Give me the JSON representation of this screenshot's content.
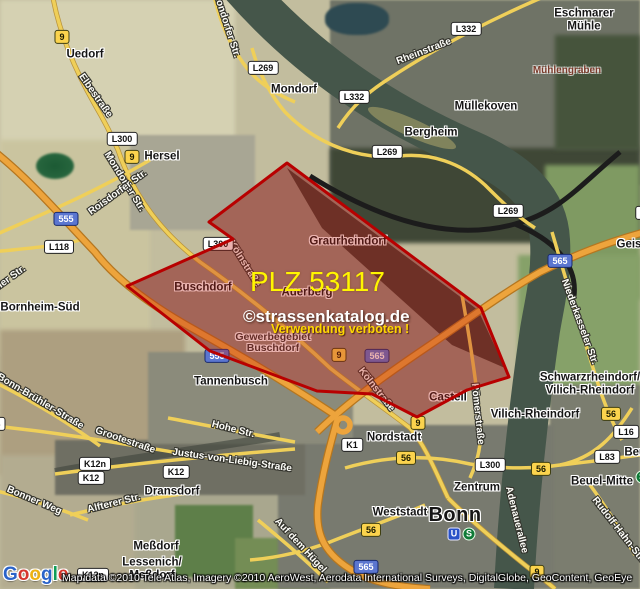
{
  "map": {
    "watermark": {
      "plz": "PLZ 53117",
      "brand": "©strassenkatalog.de",
      "warning": "Verwendung verboten !"
    },
    "attribution": {
      "line": "Map data ©2010 Tele Atlas, Imagery ©2010 AeroWest, Aerodata International Surveys, DigitalGlobe, GeoContent, GeoEye",
      "logo_letters": [
        {
          "ch": "G",
          "c": "#2a63c9"
        },
        {
          "ch": "o",
          "c": "#d6362c"
        },
        {
          "ch": "o",
          "c": "#eeb211"
        },
        {
          "ch": "g",
          "c": "#2a63c9"
        },
        {
          "ch": "l",
          "c": "#109d58"
        },
        {
          "ch": "e",
          "c": "#d6362c"
        }
      ]
    },
    "overlay": {
      "points": "287,163 481,308 509,377 467,390 417,417 372,394 317,391 210,351 127,286 233,239 209,222",
      "fill": "rgba(193,32,20,0.34)",
      "stroke": "#b80000"
    },
    "colors": {
      "overlay_border": "#b80000",
      "shield_yellow": "#fbd34d",
      "shield_blue": "#5b76d0",
      "motorway_orange": "#eda43c",
      "road_yellow": "#efcf59",
      "watermark_yellow": "#fff600",
      "river_green": "#45564a"
    },
    "towns": [
      {
        "t": "Uedorf",
        "x": 85,
        "y": 55
      },
      {
        "t": "Mondorf",
        "x": 294,
        "y": 90
      },
      {
        "t": "Hersel",
        "x": 162,
        "y": 157
      },
      {
        "t": "Eschmarer",
        "x": 584,
        "y": 14
      },
      {
        "t": "Mühle",
        "x": 584,
        "y": 27
      },
      {
        "t": "Mühlengraben",
        "x": 567,
        "y": 71,
        "cls": "nature"
      },
      {
        "t": "Müllekoven",
        "x": 486,
        "y": 107
      },
      {
        "t": "Bergheim",
        "x": 431,
        "y": 133
      },
      {
        "t": "Bornheim-Süd",
        "x": 40,
        "y": 308
      },
      {
        "t": "Geislar",
        "x": 636,
        "y": 245
      },
      {
        "t": "Graurheindorf",
        "x": 348,
        "y": 242
      },
      {
        "t": "Buschdorf",
        "x": 203,
        "y": 288
      },
      {
        "t": "Auerberg",
        "x": 307,
        "y": 293
      },
      {
        "t": "Gewerbegebiet",
        "x": 273,
        "y": 337,
        "cls": "area"
      },
      {
        "t": "Buschdorf",
        "x": 273,
        "y": 348,
        "cls": "area"
      },
      {
        "t": "Tannenbusch",
        "x": 231,
        "y": 382
      },
      {
        "t": "Castell",
        "x": 448,
        "y": 398
      },
      {
        "t": "Nordstadt",
        "x": 394,
        "y": 438
      },
      {
        "t": "Zentrum",
        "x": 477,
        "y": 488
      },
      {
        "t": "Weststadt",
        "x": 400,
        "y": 513
      },
      {
        "t": "Bonn",
        "x": 455,
        "y": 515,
        "cls": "city"
      },
      {
        "t": "Schwarzrheindorf/",
        "x": 590,
        "y": 378
      },
      {
        "t": "Vilich-Rheindorf",
        "x": 590,
        "y": 391
      },
      {
        "t": "Vilich-Rheindorf",
        "x": 535,
        "y": 415
      },
      {
        "t": "Beuel-Mitte",
        "x": 602,
        "y": 482
      },
      {
        "t": "Beuel",
        "x": 640,
        "y": 453
      },
      {
        "t": "Dransdorf",
        "x": 172,
        "y": 492
      },
      {
        "t": "Meßdorf",
        "x": 156,
        "y": 547
      },
      {
        "t": "Lessenich/",
        "x": 152,
        "y": 563
      },
      {
        "t": "Meßdorf",
        "x": 152,
        "y": 576
      }
    ],
    "streets": [
      {
        "t": "Mondorfer Str.",
        "x": 226,
        "y": 25,
        "r": 72
      },
      {
        "t": "Elbestraße",
        "x": 95,
        "y": 96,
        "r": 55
      },
      {
        "t": "Mondorfer Str.",
        "x": 124,
        "y": 182,
        "r": 58
      },
      {
        "t": "Roisdorfer Str.",
        "x": 118,
        "y": 193,
        "r": -36
      },
      {
        "t": "Rheinstraße",
        "x": 424,
        "y": 52,
        "r": -21
      },
      {
        "t": "Kölnstraße",
        "x": 244,
        "y": 264,
        "r": 58
      },
      {
        "t": "Kölnstraße",
        "x": 376,
        "y": 390,
        "r": 52
      },
      {
        "t": "Römerstraße",
        "x": 477,
        "y": 414,
        "r": 84
      },
      {
        "t": "Niederkasseler Str.",
        "x": 579,
        "y": 322,
        "r": 70
      },
      {
        "t": "Adenauerallee",
        "x": 516,
        "y": 520,
        "r": 76
      },
      {
        "t": "Rudolf-Hahn-Str.",
        "x": 618,
        "y": 530,
        "r": 52
      },
      {
        "t": "Hohe Str.",
        "x": 233,
        "y": 430,
        "r": 14
      },
      {
        "t": "Justus-von-Liebig-Straße",
        "x": 232,
        "y": 461,
        "r": 8
      },
      {
        "t": "Grootestraße",
        "x": 125,
        "y": 441,
        "r": 19
      },
      {
        "t": "Bonn-Brühler-Straße",
        "x": 40,
        "y": 402,
        "r": 31
      },
      {
        "t": "Bonner Weg",
        "x": 34,
        "y": 501,
        "r": 23
      },
      {
        "t": "Alfterer Str.",
        "x": 114,
        "y": 504,
        "r": -14
      },
      {
        "t": "Auf dem Hügel",
        "x": 300,
        "y": 546,
        "r": 47
      },
      {
        "t": "eler Str.",
        "x": 10,
        "y": 279,
        "r": -36
      }
    ],
    "shields": [
      {
        "t": "9",
        "v": "y",
        "x": 62,
        "y": 37
      },
      {
        "t": "L269",
        "v": "w",
        "x": 263,
        "y": 68
      },
      {
        "t": "L332",
        "v": "w",
        "x": 466,
        "y": 29
      },
      {
        "t": "L332",
        "v": "w",
        "x": 354,
        "y": 97
      },
      {
        "t": "L269",
        "v": "w",
        "x": 387,
        "y": 152
      },
      {
        "t": "L300",
        "v": "w",
        "x": 122,
        "y": 139
      },
      {
        "t": "9",
        "v": "y",
        "x": 132,
        "y": 157
      },
      {
        "t": "555",
        "v": "b",
        "x": 66,
        "y": 219
      },
      {
        "t": "L118",
        "v": "w",
        "x": 59,
        "y": 247
      },
      {
        "t": "L300",
        "v": "w",
        "x": 218,
        "y": 244
      },
      {
        "t": "L269",
        "v": "w",
        "x": 508,
        "y": 211
      },
      {
        "t": "565",
        "v": "b",
        "x": 560,
        "y": 261
      },
      {
        "t": "L16",
        "v": "w",
        "x": 648,
        "y": 213
      },
      {
        "t": "555",
        "v": "b",
        "x": 217,
        "y": 356
      },
      {
        "t": "9",
        "v": "y",
        "x": 339,
        "y": 355
      },
      {
        "t": "565",
        "v": "b",
        "x": 377,
        "y": 356
      },
      {
        "t": "9",
        "v": "y",
        "x": 418,
        "y": 423
      },
      {
        "t": "K1",
        "v": "w",
        "x": 352,
        "y": 445
      },
      {
        "t": "56",
        "v": "y",
        "x": 406,
        "y": 458
      },
      {
        "t": "L300",
        "v": "w",
        "x": 490,
        "y": 465
      },
      {
        "t": "56",
        "v": "y",
        "x": 541,
        "y": 469
      },
      {
        "t": "56",
        "v": "y",
        "x": 611,
        "y": 414
      },
      {
        "t": "L16",
        "v": "w",
        "x": 626,
        "y": 432
      },
      {
        "t": "L83",
        "v": "w",
        "x": 607,
        "y": 457
      },
      {
        "t": "56",
        "v": "y",
        "x": 371,
        "y": 530
      },
      {
        "t": "565",
        "v": "b",
        "x": 366,
        "y": 567
      },
      {
        "t": "9",
        "v": "y",
        "x": 537,
        "y": 572
      },
      {
        "t": "K12n",
        "v": "w",
        "x": 95,
        "y": 464
      },
      {
        "t": "K12",
        "v": "w",
        "x": 91,
        "y": 478
      },
      {
        "t": "K12",
        "v": "w",
        "x": 176,
        "y": 472
      },
      {
        "t": "K12n",
        "v": "w",
        "x": 93,
        "y": 575
      },
      {
        "t": "3",
        "v": "w",
        "x": -2,
        "y": 424
      }
    ],
    "transit_icons": [
      {
        "t": "U",
        "k": "ubahn-icon",
        "x": 454,
        "y": 534
      },
      {
        "t": "S",
        "k": "sbahn-icon",
        "x": 469,
        "y": 534
      },
      {
        "t": "S",
        "k": "sbahn-icon",
        "x": 642,
        "y": 477
      }
    ]
  }
}
